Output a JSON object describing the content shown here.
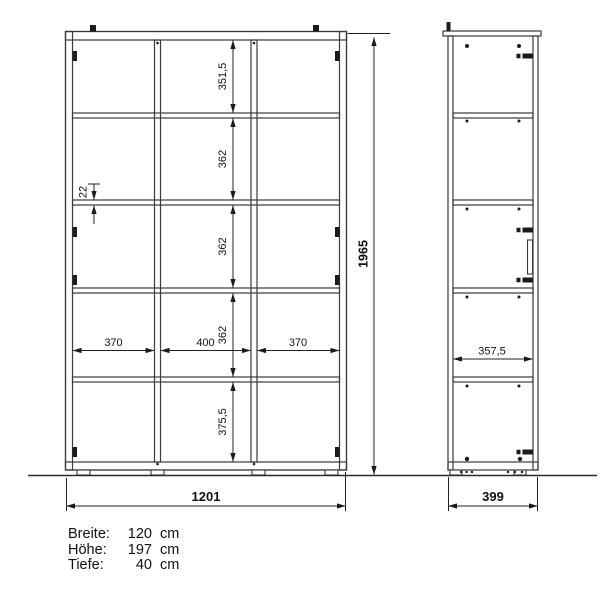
{
  "front_view": {
    "height_total": "1965",
    "width_total": "1201",
    "compartments": [
      "351,5",
      "362",
      "362",
      "362",
      "375,5"
    ],
    "shelf_thickness": "22",
    "bay_widths": [
      "370",
      "400",
      "370"
    ]
  },
  "side_view": {
    "depth_total": "399",
    "depth_interior": "357,5"
  },
  "legend": {
    "rows": [
      {
        "label": "Breite:",
        "value": "120",
        "unit": "cm"
      },
      {
        "label": "Höhe:",
        "value": "197",
        "unit": "cm"
      },
      {
        "label": "Tiefe:",
        "value": "40",
        "unit": "cm"
      }
    ]
  },
  "colors": {
    "line": "#3a3a3a",
    "background": "#ffffff"
  }
}
